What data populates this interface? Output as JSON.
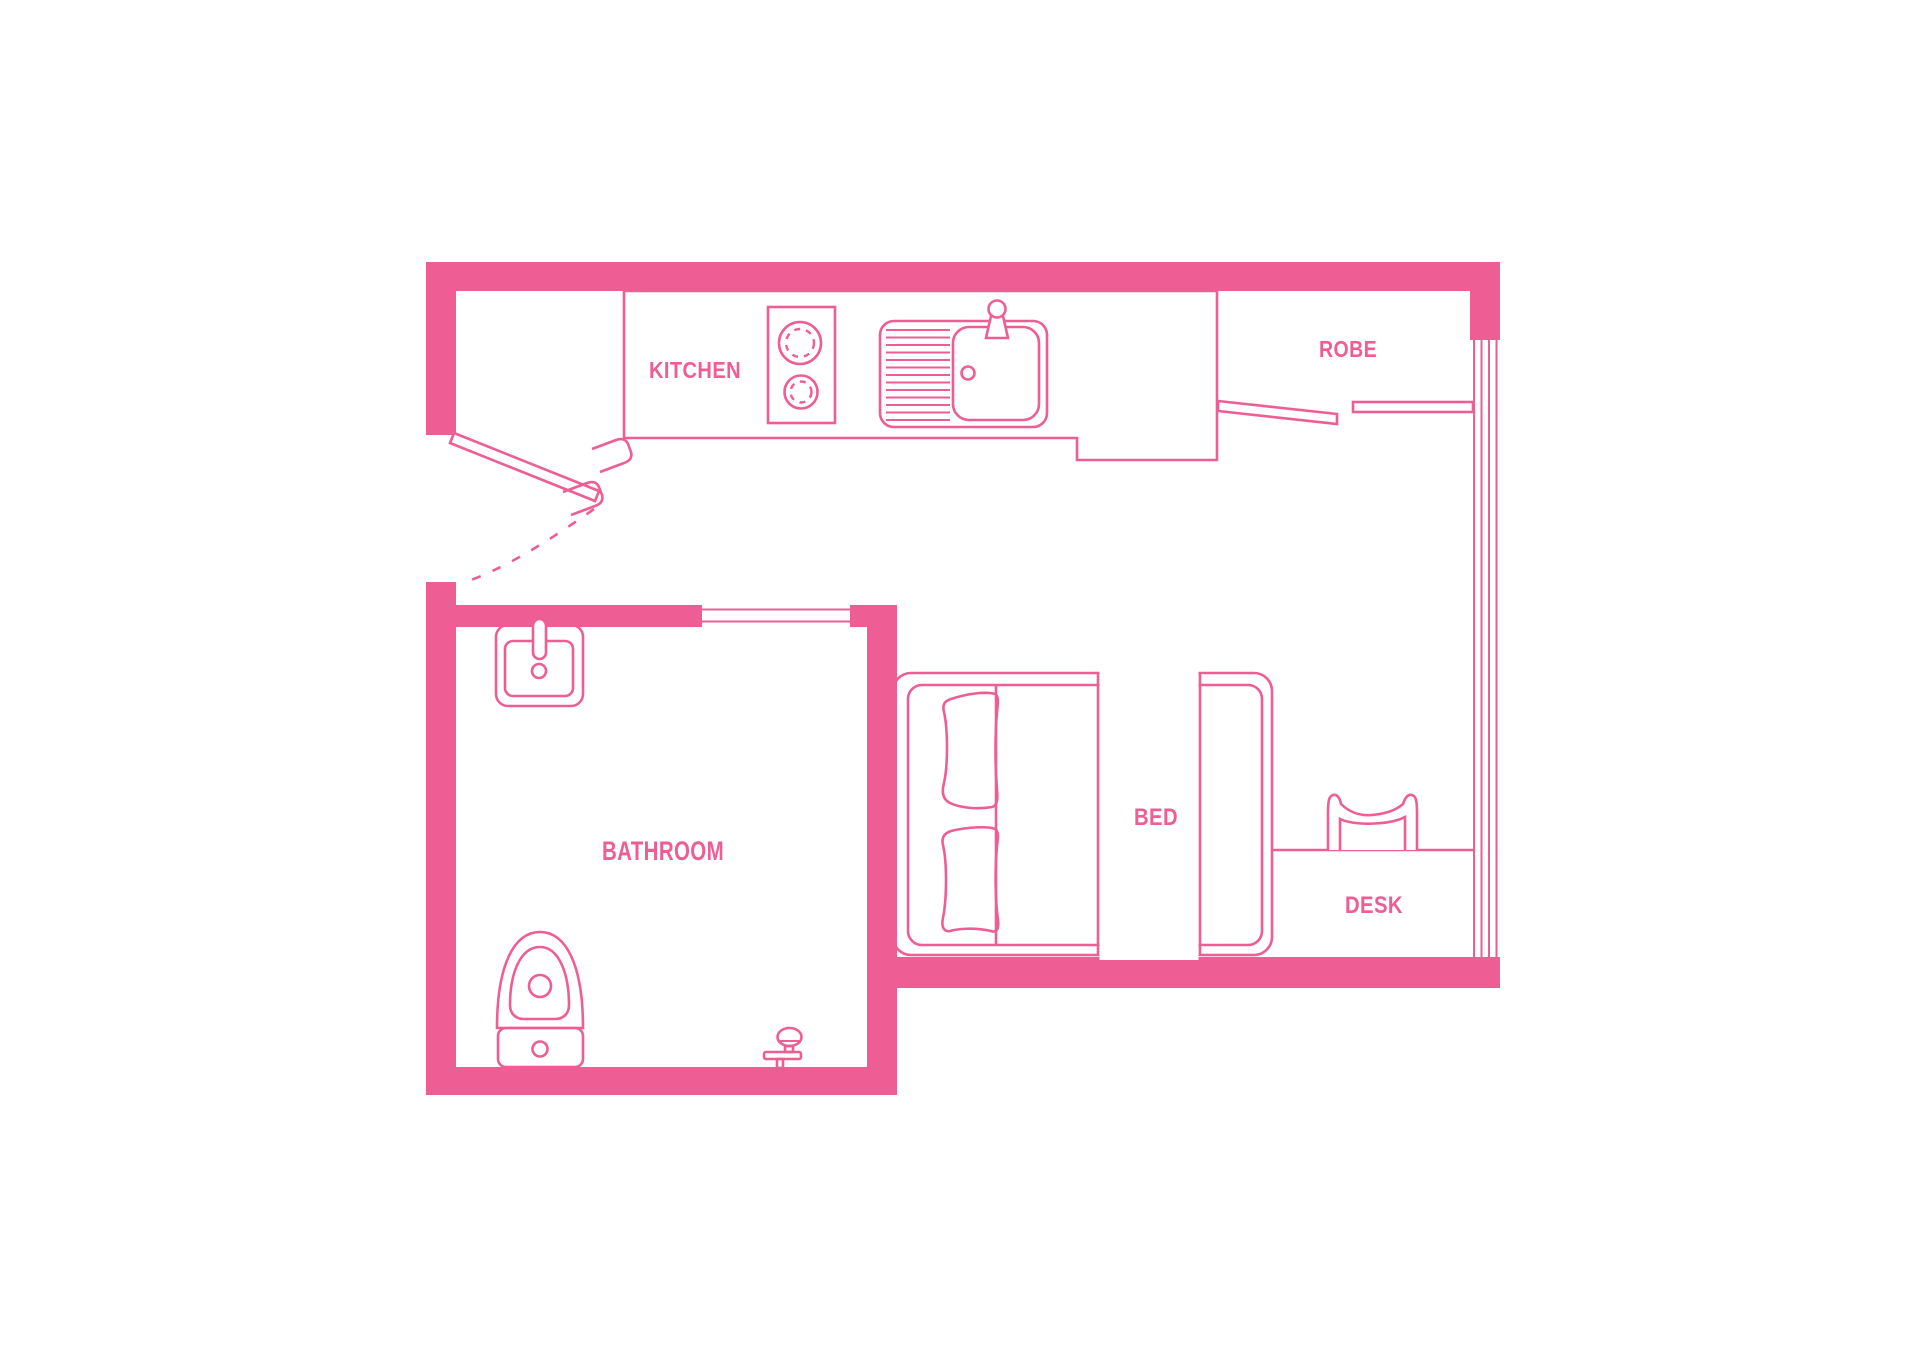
{
  "title": "Studio apartment floor plan",
  "colors": {
    "accent": "#EE5E95",
    "background": "#FFFFFF"
  },
  "rooms": {
    "kitchen": {
      "label": "KITCHEN"
    },
    "robe": {
      "label": "ROBE"
    },
    "bathroom": {
      "label": "BATHROOM"
    },
    "bed": {
      "label": "BED"
    },
    "desk": {
      "label": "DESK"
    }
  }
}
